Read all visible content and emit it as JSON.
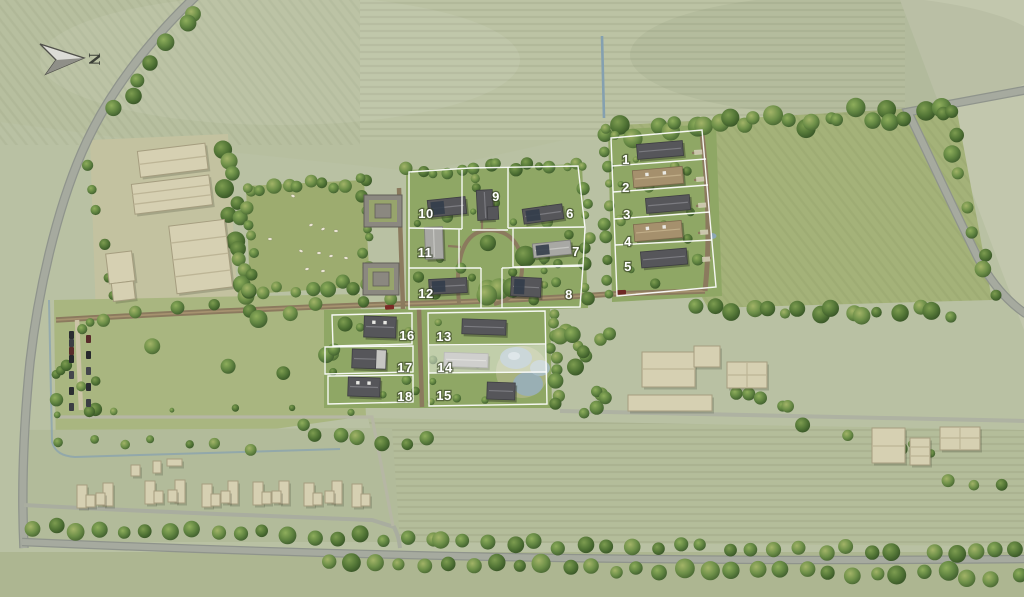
{
  "map": {
    "compass_label": "N",
    "plots": [
      {
        "number": "1"
      },
      {
        "number": "2"
      },
      {
        "number": "3"
      },
      {
        "number": "4"
      },
      {
        "number": "5"
      },
      {
        "number": "6"
      },
      {
        "number": "7"
      },
      {
        "number": "8"
      },
      {
        "number": "9"
      },
      {
        "number": "10"
      },
      {
        "number": "11"
      },
      {
        "number": "12"
      },
      {
        "number": "13"
      },
      {
        "number": "14"
      },
      {
        "number": "15"
      },
      {
        "number": "16"
      },
      {
        "number": "17"
      },
      {
        "number": "18"
      }
    ],
    "highlighted_plot_number": "14",
    "colors": {
      "field": "#b9c1a3",
      "site_grass": "#8fa765",
      "meadow": "#a4b279",
      "tree_dark": "#3c5a2a",
      "dirt_road": "#8b7a5e",
      "asphalt_road": "#a3a79e",
      "water": "#9fb6c2",
      "building_beige": "#d6d0b2",
      "roof_dark": "#56565a",
      "roof_tan": "#a5906d",
      "plot_outline": "#ffffff",
      "highlight_overlay": "rgba(255,255,255,0.45)"
    }
  }
}
